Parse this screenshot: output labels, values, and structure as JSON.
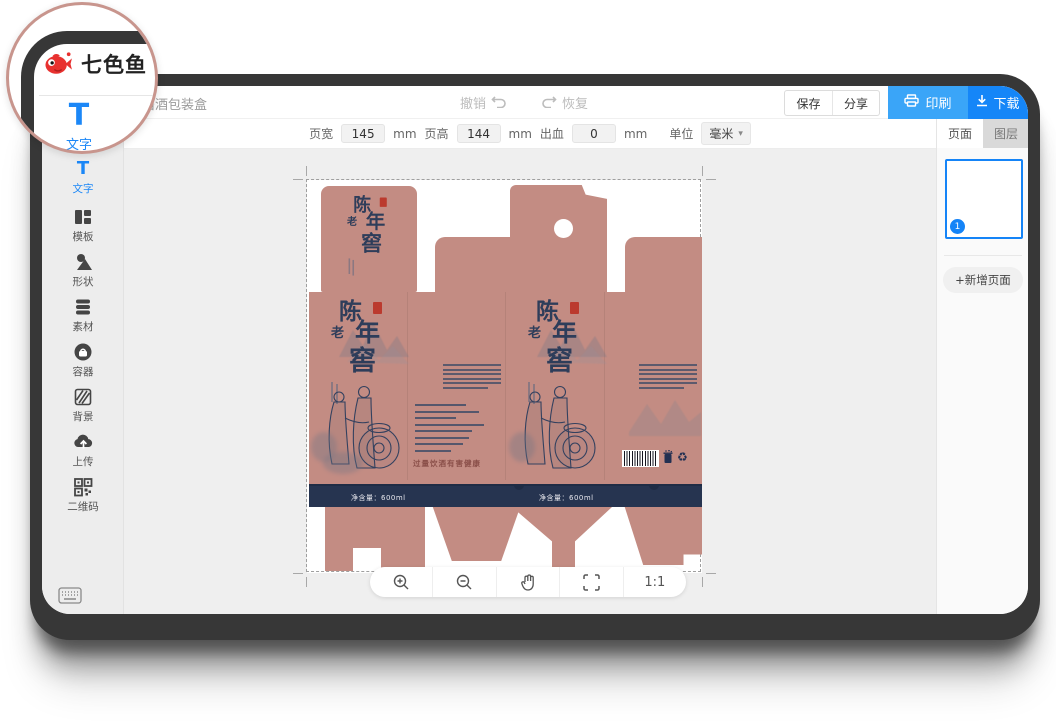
{
  "colors": {
    "accent_blue": "#1586f8",
    "print_blue": "#3aa5f8",
    "rose": "#c38c83",
    "navy": "#2e3d5a",
    "band_navy": "#263450",
    "loupe_ring": "#c8958d",
    "logo_red": "#e8312f"
  },
  "loupe": {
    "logo_text": "七色鱼",
    "tool_letter": "T",
    "tool_label": "文字"
  },
  "header": {
    "doc_title": "酱酒包装盒",
    "undo_label": "撤销",
    "redo_label": "恢复",
    "save_label": "保存",
    "share_label": "分享",
    "print_label": "印刷",
    "download_label": "下载"
  },
  "dimension_bar": {
    "width_label": "页宽",
    "width_value": "145",
    "width_unit": "mm",
    "height_label": "页高",
    "height_value": "144",
    "height_unit": "mm",
    "bleed_label": "出血",
    "bleed_value": "0",
    "bleed_unit": "mm",
    "unit_label": "单位",
    "unit_value": "毫米"
  },
  "sidebar": {
    "items": [
      {
        "id": "text",
        "label": "文字"
      },
      {
        "id": "template",
        "label": "模板"
      },
      {
        "id": "shape",
        "label": "形状"
      },
      {
        "id": "material",
        "label": "素材"
      },
      {
        "id": "container",
        "label": "容器"
      },
      {
        "id": "background",
        "label": "背景"
      },
      {
        "id": "upload",
        "label": "上传"
      },
      {
        "id": "qrcode",
        "label": "二维码"
      }
    ]
  },
  "right_panel": {
    "tab_page": "页面",
    "tab_layer": "图层",
    "page_number": "1",
    "add_page_label": "+新增页面"
  },
  "artboard": {
    "brand_chars": [
      "陈",
      "老",
      "年",
      "窖"
    ],
    "warning_text": "过量饮酒有害健康",
    "net_content": "净含量：600ml"
  },
  "bottom_toolbar": {
    "ratio_label": "1:1"
  }
}
